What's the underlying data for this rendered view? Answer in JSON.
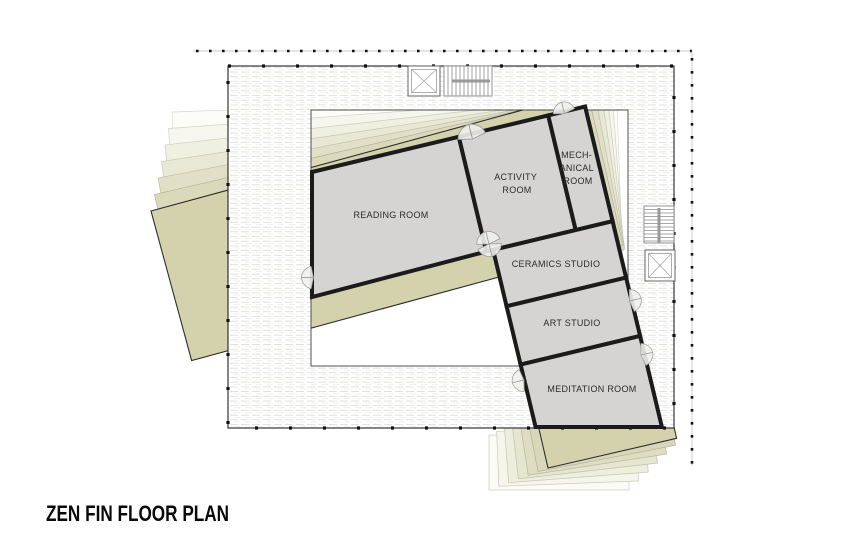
{
  "title": "ZEN FIN FLOOR PLAN",
  "colors": {
    "background": "#ffffff",
    "room_fill": "#d5d4d2",
    "wall": "#1b1b1b",
    "olive_sheet": "#d3d2ad",
    "deck_hatch_line": "#d6d6d2",
    "roof_dash": "#b7b7b7"
  },
  "rooms": [
    {
      "id": "reading-room",
      "label": "READING ROOM"
    },
    {
      "id": "activity-room",
      "label": "ACTIVITY ROOM",
      "lines": [
        "ACTIVITY",
        "ROOM"
      ]
    },
    {
      "id": "mechanical-room",
      "label": "MECHANICAL ROOM",
      "lines": [
        "MECH-",
        "ANICAL",
        "ROOM"
      ]
    },
    {
      "id": "ceramics-studio",
      "label": "CERAMICS STUDIO"
    },
    {
      "id": "art-studio",
      "label": "ART STUDIO"
    },
    {
      "id": "meditation-room",
      "label": "MEDITATION ROOM"
    }
  ],
  "icons": [
    {
      "name": "elevator-icon",
      "count": 2
    },
    {
      "name": "stairs-icon",
      "count": 2
    },
    {
      "name": "door-swing-icon",
      "count": 7
    }
  ]
}
